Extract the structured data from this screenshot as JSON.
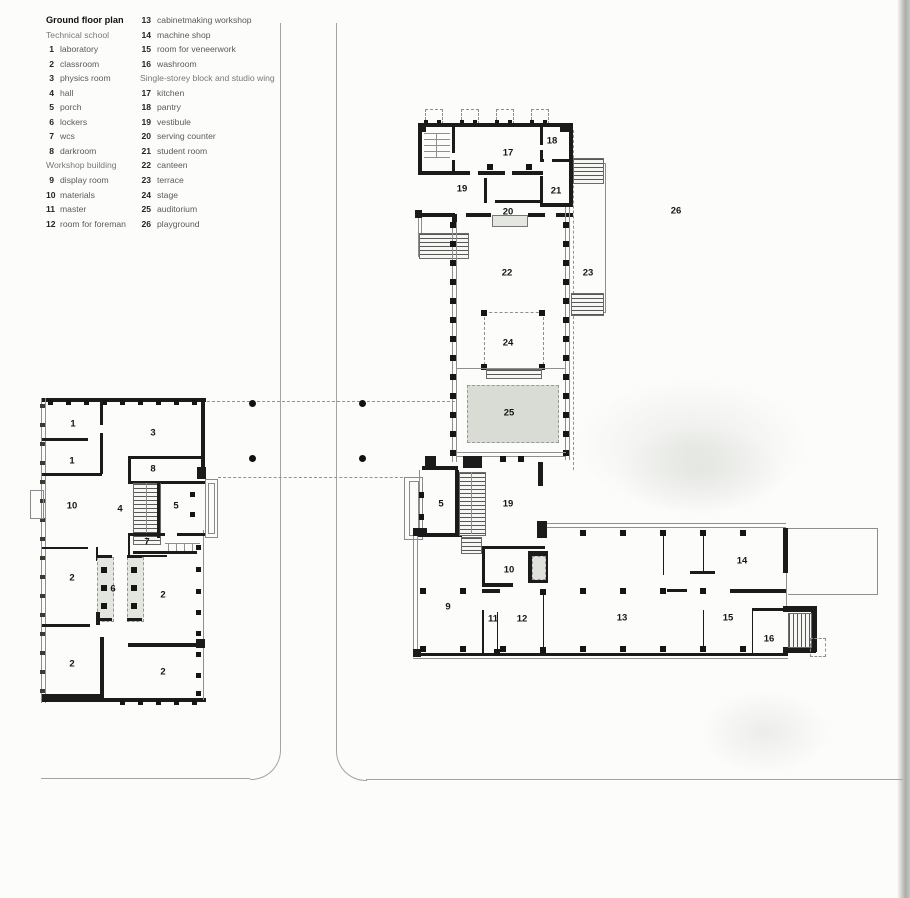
{
  "title": "Ground floor plan",
  "colors": {
    "paper": "#fcfcfa",
    "wall": "#1b1b1b",
    "shaded_area": "#d9dcd5",
    "road_line": "#a3a3a0"
  },
  "legend": {
    "col1": [
      {
        "type": "title",
        "text": "Ground floor plan"
      },
      {
        "type": "header",
        "text": "Technical school"
      },
      {
        "type": "item",
        "num": "1",
        "label": "laboratory"
      },
      {
        "type": "item",
        "num": "2",
        "label": "classroom"
      },
      {
        "type": "item",
        "num": "3",
        "label": "physics room"
      },
      {
        "type": "item",
        "num": "4",
        "label": "hall"
      },
      {
        "type": "item",
        "num": "5",
        "label": "porch"
      },
      {
        "type": "item",
        "num": "6",
        "label": "lockers"
      },
      {
        "type": "item",
        "num": "7",
        "label": "wcs"
      },
      {
        "type": "item",
        "num": "8",
        "label": "darkroom"
      },
      {
        "type": "header",
        "text": "Workshop building"
      },
      {
        "type": "item",
        "num": "9",
        "label": "display room"
      },
      {
        "type": "item",
        "num": "10",
        "label": "materials"
      },
      {
        "type": "item",
        "num": "11",
        "label": "master"
      },
      {
        "type": "item",
        "num": "12",
        "label": "room for foreman"
      }
    ],
    "col2": [
      {
        "type": "item",
        "num": "13",
        "label": "cabinetmaking workshop"
      },
      {
        "type": "item",
        "num": "14",
        "label": "machine shop"
      },
      {
        "type": "item",
        "num": "15",
        "label": "room for veneerwork"
      },
      {
        "type": "item",
        "num": "16",
        "label": "washroom"
      },
      {
        "type": "header",
        "text": "Single-storey block and studio wing"
      },
      {
        "type": "item",
        "num": "17",
        "label": "kitchen"
      },
      {
        "type": "item",
        "num": "18",
        "label": "pantry"
      },
      {
        "type": "item",
        "num": "19",
        "label": "vestibule"
      },
      {
        "type": "item",
        "num": "20",
        "label": "serving counter"
      },
      {
        "type": "item",
        "num": "21",
        "label": "student room"
      },
      {
        "type": "item",
        "num": "22",
        "label": "canteen"
      },
      {
        "type": "item",
        "num": "23",
        "label": "terrace"
      },
      {
        "type": "item",
        "num": "24",
        "label": "stage"
      },
      {
        "type": "item",
        "num": "25",
        "label": "auditorium"
      },
      {
        "type": "item",
        "num": "26",
        "label": "playground"
      }
    ]
  },
  "plan": {
    "labels": [
      {
        "text": "1",
        "room": "laboratory",
        "x": 73,
        "y": 424
      },
      {
        "text": "1",
        "room": "laboratory",
        "x": 72,
        "y": 461
      },
      {
        "text": "3",
        "room": "physics room",
        "x": 153,
        "y": 433
      },
      {
        "text": "8",
        "room": "darkroom",
        "x": 153,
        "y": 469
      },
      {
        "text": "10",
        "room": "materials",
        "x": 72,
        "y": 506
      },
      {
        "text": "4",
        "room": "hall",
        "x": 120,
        "y": 509
      },
      {
        "text": "5",
        "room": "porch",
        "x": 176,
        "y": 506
      },
      {
        "text": "7",
        "room": "wcs",
        "x": 147,
        "y": 542
      },
      {
        "text": "2",
        "room": "classroom",
        "x": 72,
        "y": 578
      },
      {
        "text": "6",
        "room": "lockers",
        "x": 113,
        "y": 589
      },
      {
        "text": "2",
        "room": "classroom",
        "x": 163,
        "y": 595
      },
      {
        "text": "2",
        "room": "classroom",
        "x": 72,
        "y": 664
      },
      {
        "text": "2",
        "room": "classroom",
        "x": 163,
        "y": 672
      },
      {
        "text": "17",
        "room": "kitchen",
        "x": 508,
        "y": 153
      },
      {
        "text": "18",
        "room": "pantry",
        "x": 552,
        "y": 141
      },
      {
        "text": "19",
        "room": "vestibule",
        "x": 462,
        "y": 189
      },
      {
        "text": "21",
        "room": "student room",
        "x": 556,
        "y": 191
      },
      {
        "text": "20",
        "room": "serving counter",
        "x": 508,
        "y": 212
      },
      {
        "text": "22",
        "room": "canteen",
        "x": 507,
        "y": 273
      },
      {
        "text": "23",
        "room": "terrace",
        "x": 588,
        "y": 273
      },
      {
        "text": "26",
        "room": "playground",
        "x": 676,
        "y": 211
      },
      {
        "text": "24",
        "room": "stage",
        "x": 508,
        "y": 343
      },
      {
        "text": "25",
        "room": "auditorium",
        "x": 509,
        "y": 413
      },
      {
        "text": "5",
        "room": "porch",
        "x": 441,
        "y": 504
      },
      {
        "text": "19",
        "room": "vestibule",
        "x": 508,
        "y": 504
      },
      {
        "text": "9",
        "room": "display room",
        "x": 448,
        "y": 607
      },
      {
        "text": "10",
        "room": "materials",
        "x": 509,
        "y": 570
      },
      {
        "text": "11",
        "room": "master",
        "x": 493,
        "y": 619
      },
      {
        "text": "12",
        "room": "room for foreman",
        "x": 522,
        "y": 619
      },
      {
        "text": "13",
        "room": "cabinetmaking workshop",
        "x": 622,
        "y": 618
      },
      {
        "text": "14",
        "room": "machine shop",
        "x": 742,
        "y": 561
      },
      {
        "text": "15",
        "room": "room for veneerwork",
        "x": 728,
        "y": 618
      },
      {
        "text": "16",
        "room": "washroom",
        "x": 769,
        "y": 639
      }
    ]
  }
}
